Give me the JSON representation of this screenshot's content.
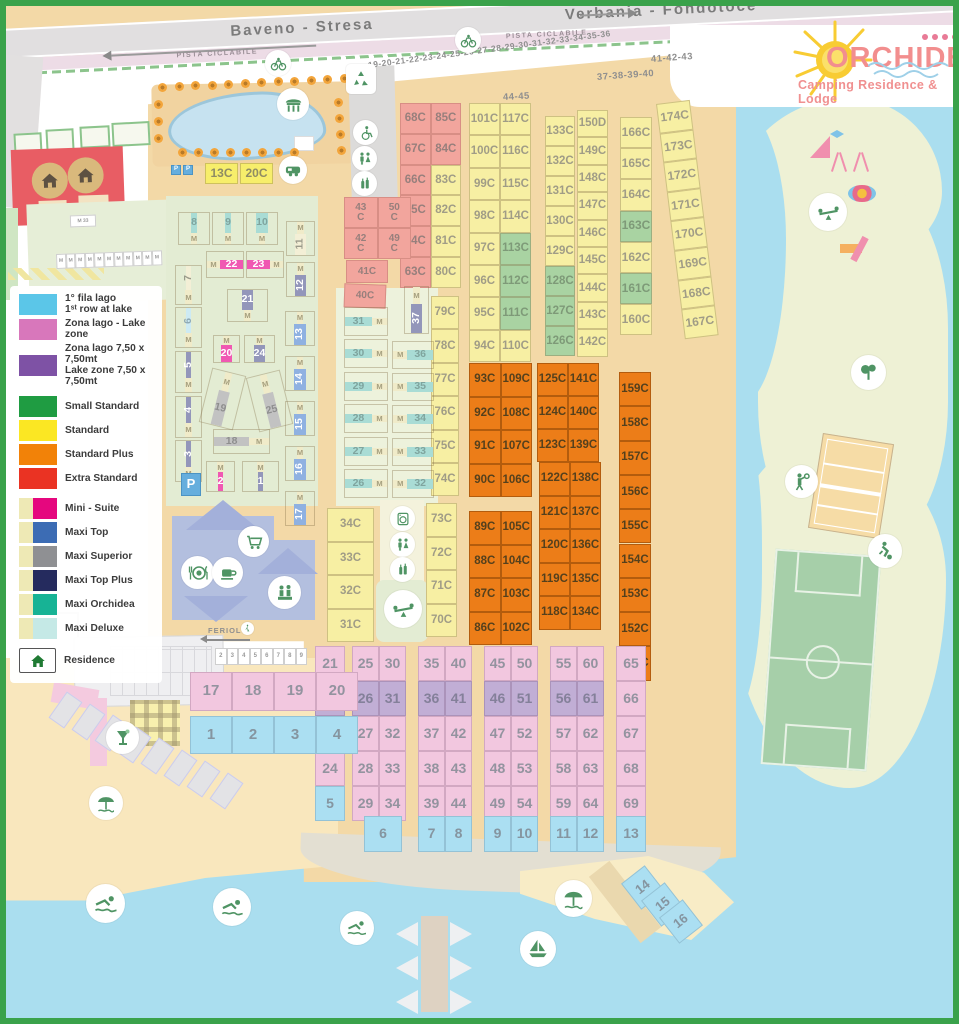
{
  "roads": {
    "left_label": "Baveno - Stresa",
    "right_label": "Verbania - Fondotoce",
    "cycle_path_label": "PISTA CICLABILE",
    "feriolo_label": "FERIOLO"
  },
  "logo": {
    "title": "ORCHIDEA",
    "subtitle": "Camping Residence & Lodge",
    "stars": 4
  },
  "legend": {
    "items": [
      {
        "sw": [
          "#5bc6e8"
        ],
        "t": "1° fila lago",
        "t2": "1ˢᵗ row at lake"
      },
      {
        "sw": [
          "#d877bb"
        ],
        "t": "Zona lago - Lake zone"
      },
      {
        "sw": [
          "#7e52a5"
        ],
        "t": "Zona lago 7,50 x 7,50mt",
        "t2": "Lake zone 7,50 x 7,50mt"
      },
      {
        "sw": [
          "#1f9c42"
        ],
        "t": "Small Standard",
        "gap": true
      },
      {
        "sw": [
          "#fbe723"
        ],
        "t": "Standard"
      },
      {
        "sw": [
          "#f28208"
        ],
        "t": "Standard Plus"
      },
      {
        "sw": [
          "#ea3323"
        ],
        "t": "Extra Standard"
      },
      {
        "sw": [
          "#eee9b5",
          "#e5077e"
        ],
        "t": "Mini - Suite",
        "gap": true
      },
      {
        "sw": [
          "#eee9b5",
          "#3c6cb4"
        ],
        "t": "Maxi Top"
      },
      {
        "sw": [
          "#eee9b5",
          "#8f9093"
        ],
        "t": "Maxi Superior"
      },
      {
        "sw": [
          "#eee9b5",
          "#252b5e"
        ],
        "t": "Maxi Top Plus"
      },
      {
        "sw": [
          "#eee9b5",
          "#17b395"
        ],
        "t": "Maxi Orchidea"
      },
      {
        "sw": [
          "#eee9b5",
          "#c5e9e6"
        ],
        "t": "Maxi Deluxe"
      },
      {
        "house": true,
        "t": "Residence",
        "gap": true
      }
    ]
  },
  "labels": [
    {
      "t": "19-20-21-22-23-24-25-26-27-28-29-30-31-32-33-34-35-36",
      "x": 368,
      "y": 60,
      "fs": 8.5,
      "rot": -7.5
    },
    {
      "t": "37-38-39-40",
      "x": 597,
      "y": 72,
      "fs": 9.5,
      "rot": -4
    },
    {
      "t": "41-42-43",
      "x": 651,
      "y": 54,
      "fs": 9.5,
      "rot": -4
    },
    {
      "t": "44-45",
      "x": 503,
      "y": 92,
      "fs": 9.5,
      "rot": -3
    }
  ],
  "grids": [
    {
      "id": "red-col",
      "x": 400,
      "y": 103,
      "cols": 2,
      "cw": 30.5,
      "ch": 30.8,
      "c": "red",
      "cells": [
        "68C",
        "85C",
        "67C",
        "84C",
        "66C",
        "83C|yellow",
        "65C",
        "82C|yellow",
        "64C",
        "81C|yellow",
        "63C",
        "80C|yellow"
      ]
    },
    {
      "id": "yellow-a",
      "x": 469,
      "y": 103,
      "cols": 2,
      "cw": 31,
      "ch": 32.4,
      "c": "yellow",
      "cells": [
        "101C",
        "117C",
        "100C",
        "116C",
        "99C",
        "115C",
        "98C",
        "114C",
        "97C",
        "113C|green",
        "96C",
        "112C|green",
        "95C",
        "111C|green",
        "94C",
        "110C"
      ]
    },
    {
      "id": "yellow-b",
      "x": 545,
      "y": 116,
      "cols": 1,
      "cw": 30,
      "ch": 30,
      "c": "yellow",
      "cells": [
        "133C",
        "132C",
        "131C",
        "130C",
        "129C",
        "128C|green",
        "127C|green",
        "126C|green"
      ]
    },
    {
      "id": "yellow-c",
      "x": 577,
      "y": 110,
      "cols": 1,
      "cw": 31,
      "ch": 27.4,
      "c": "yellow",
      "cells": [
        "150D",
        "149C",
        "148C",
        "147C",
        "146C",
        "145C",
        "144C",
        "143C",
        "142C"
      ]
    },
    {
      "id": "yellow-d",
      "x": 620,
      "y": 117,
      "cols": 1,
      "cw": 32,
      "ch": 31.2,
      "c": "yellow",
      "fs": 12,
      "cells": [
        "166C",
        "165C",
        "164C",
        "163C|green",
        "162C",
        "161C|green",
        "160C"
      ]
    },
    {
      "id": "yellow-e",
      "x": 656,
      "y": 104,
      "cols": 1,
      "cw": 34,
      "ch": 29.6,
      "c": "yellow",
      "fs": 12,
      "rot": -7,
      "cells": [
        "174C",
        "173C",
        "172C",
        "171C",
        "170C",
        "169C",
        "168C",
        "167C"
      ]
    },
    {
      "id": "yellow-f",
      "x": 431,
      "y": 296,
      "cols": 1,
      "cw": 28,
      "ch": 33.4,
      "c": "yellow",
      "cells": [
        "79C",
        "78C",
        "77C",
        "76C",
        "75C",
        "74C"
      ]
    },
    {
      "id": "yellow-g",
      "x": 426,
      "y": 503,
      "cols": 1,
      "cw": 31,
      "ch": 33.5,
      "c": "yellow",
      "cells": [
        "73C",
        "72C",
        "71C",
        "70C"
      ]
    },
    {
      "id": "yellow-h",
      "x": 327,
      "y": 508,
      "cols": 1,
      "cw": 47,
      "ch": 33.5,
      "c": "yellow",
      "cells": [
        "34C",
        "33C",
        "32C",
        "31C"
      ]
    },
    {
      "id": "orange-a",
      "x": 469,
      "y": 363,
      "cols": 2,
      "cw": 31.5,
      "ch": 33.5,
      "c": "orange",
      "cells": [
        "93C",
        "109C",
        "92C",
        "108C",
        "91C",
        "107C",
        "90C",
        "106C"
      ]
    },
    {
      "id": "orange-b",
      "x": 537,
      "y": 363,
      "cols": 2,
      "cw": 31,
      "ch": 33,
      "c": "orange",
      "cells": [
        "125C",
        "141C",
        "124C",
        "140C",
        "123C",
        "139C"
      ]
    },
    {
      "id": "orange-c",
      "x": 539,
      "y": 462,
      "cols": 2,
      "cw": 31,
      "ch": 33.5,
      "c": "orange",
      "cells": [
        "122C",
        "138C",
        "121C",
        "137C",
        "120C",
        "136C",
        "119C",
        "135C",
        "118C",
        "134C"
      ]
    },
    {
      "id": "orange-d",
      "x": 469,
      "y": 511,
      "cols": 2,
      "cw": 31.5,
      "ch": 33.5,
      "c": "orange",
      "cells": [
        "89C",
        "105C",
        "88C",
        "104C",
        "87C",
        "103C",
        "86C",
        "102C"
      ]
    },
    {
      "id": "orange-e",
      "x": 619,
      "y": 372,
      "cols": 1,
      "cw": 32,
      "ch": 34.3,
      "c": "orange",
      "cells": [
        "159C",
        "158C",
        "157C",
        "156C",
        "155C",
        "154C",
        "153C",
        "152C",
        "151C"
      ]
    },
    {
      "id": "pink-4350",
      "x": 344,
      "y": 197,
      "cols": 2,
      "cw": 33.5,
      "ch": 31,
      "c": "red",
      "fs": 10,
      "cells": [
        "43\nC",
        "50\nC",
        "42\nC",
        "49\nC"
      ]
    },
    {
      "id": "b-21",
      "x": 315,
      "y": 646,
      "cols": 1,
      "cw": 30,
      "ch": 35,
      "c": "pink",
      "fs": 14,
      "cells": [
        "21",
        "22|purple",
        "23",
        "24",
        "5|blue"
      ]
    },
    {
      "id": "b-2530",
      "x": 352,
      "y": 646,
      "cols": 2,
      "cw": 27,
      "ch": 35,
      "c": "pink",
      "fs": 14,
      "cells": [
        "25",
        "30",
        "26|purple",
        "31|purple",
        "27",
        "32",
        "28",
        "33",
        "29",
        "34"
      ]
    },
    {
      "id": "b-3540",
      "x": 418,
      "y": 646,
      "cols": 2,
      "cw": 27,
      "ch": 35,
      "c": "pink",
      "fs": 14,
      "cells": [
        "35",
        "40",
        "36|purple",
        "41|purple",
        "37",
        "42",
        "38",
        "43",
        "39",
        "44"
      ]
    },
    {
      "id": "b-4550",
      "x": 484,
      "y": 646,
      "cols": 2,
      "cw": 27,
      "ch": 35,
      "c": "pink",
      "fs": 14,
      "cells": [
        "45",
        "50",
        "46|purple",
        "51|purple",
        "47",
        "52",
        "48",
        "53",
        "49",
        "54"
      ]
    },
    {
      "id": "b-5560",
      "x": 550,
      "y": 646,
      "cols": 2,
      "cw": 27,
      "ch": 35,
      "c": "pink",
      "fs": 14,
      "cells": [
        "55",
        "60",
        "56|purple",
        "61|purple",
        "57",
        "62",
        "58",
        "63",
        "59",
        "64"
      ]
    },
    {
      "id": "b-65",
      "x": 616,
      "y": 646,
      "cols": 1,
      "cw": 30,
      "ch": 35,
      "c": "pink",
      "fs": 14,
      "cells": [
        "65",
        "66",
        "67",
        "68",
        "69"
      ]
    },
    {
      "id": "b-blue78",
      "x": 418,
      "y": 816,
      "cols": 2,
      "cw": 27,
      "ch": 36,
      "c": "blue",
      "fs": 14,
      "cells": [
        "7",
        "8"
      ]
    },
    {
      "id": "b-blue910",
      "x": 484,
      "y": 816,
      "cols": 2,
      "cw": 27,
      "ch": 36,
      "c": "blue",
      "fs": 14,
      "cells": [
        "9",
        "10"
      ]
    },
    {
      "id": "b-blue1112",
      "x": 550,
      "y": 816,
      "cols": 2,
      "cw": 27,
      "ch": 36,
      "c": "blue",
      "fs": 14,
      "cells": [
        "11",
        "12"
      ]
    },
    {
      "id": "b-1720",
      "x": 190,
      "y": 672,
      "cols": 4,
      "cw": 42,
      "ch": 39,
      "c": "pink",
      "fs": 15,
      "cells": [
        "17",
        "18",
        "19",
        "20"
      ]
    },
    {
      "id": "b-1-4",
      "x": 190,
      "y": 716,
      "cols": 4,
      "cw": 42,
      "ch": 38,
      "c": "blue",
      "fs": 15,
      "cells": [
        "1",
        "2",
        "3",
        "4"
      ]
    },
    {
      "id": "tiny-row",
      "x": 215,
      "y": 648,
      "cols": 8,
      "cw": 11.5,
      "ch": 17,
      "c": "white",
      "fs": 6,
      "cells": [
        "2",
        "3",
        "4",
        "5",
        "6",
        "7",
        "8",
        "9"
      ]
    },
    {
      "id": "m-tiny-row",
      "x": 56,
      "y": 254,
      "cols": 11,
      "cw": 9.6,
      "ch": 15,
      "c": "white",
      "fs": 5,
      "rot": -2,
      "cells": [
        "M",
        "M",
        "M",
        "M",
        "M",
        "M",
        "M",
        "M",
        "M",
        "M",
        "M"
      ]
    }
  ],
  "free_lots": [
    {
      "t": "41C",
      "x": 346,
      "y": 260,
      "w": 42,
      "h": 23,
      "c": "red",
      "fs": 10
    },
    {
      "t": "40C",
      "x": 344,
      "y": 284,
      "w": 42,
      "h": 24,
      "c": "red",
      "fs": 10,
      "rot": 2
    },
    {
      "t": "13C",
      "x": 205,
      "y": 163,
      "w": 33,
      "h": 21,
      "c": "brightyellow",
      "fs": 12
    },
    {
      "t": "20C",
      "x": 240,
      "y": 163,
      "w": 33,
      "h": 21,
      "c": "brightyellow",
      "fs": 12
    },
    {
      "t": "P",
      "x": 171,
      "y": 165,
      "w": 10,
      "h": 10,
      "c": "pblue",
      "fs": 6
    },
    {
      "t": "P",
      "x": 183,
      "y": 165,
      "w": 10,
      "h": 10,
      "c": "pblue",
      "fs": 6
    },
    {
      "t": "31",
      "x": 344,
      "y": 307,
      "w": 44,
      "h": 29,
      "c": "tealM",
      "m": "r"
    },
    {
      "t": "30",
      "x": 344,
      "y": 339,
      "w": 44,
      "h": 29,
      "c": "tealM",
      "m": "r"
    },
    {
      "t": "29",
      "x": 344,
      "y": 372,
      "w": 44,
      "h": 29,
      "c": "tealM",
      "m": "r"
    },
    {
      "t": "28",
      "x": 344,
      "y": 404,
      "w": 44,
      "h": 29,
      "c": "tealM",
      "m": "r"
    },
    {
      "t": "27",
      "x": 344,
      "y": 437,
      "w": 44,
      "h": 29,
      "c": "tealM",
      "m": "r"
    },
    {
      "t": "26",
      "x": 344,
      "y": 469,
      "w": 44,
      "h": 29,
      "c": "tealM",
      "m": "r"
    },
    {
      "t": "36",
      "x": 392,
      "y": 341,
      "w": 42,
      "h": 28,
      "c": "tealM",
      "m": "l"
    },
    {
      "t": "35",
      "x": 392,
      "y": 373,
      "w": 42,
      "h": 28,
      "c": "tealM",
      "m": "l"
    },
    {
      "t": "34",
      "x": 392,
      "y": 405,
      "w": 42,
      "h": 28,
      "c": "tealM",
      "m": "l"
    },
    {
      "t": "33",
      "x": 392,
      "y": 438,
      "w": 42,
      "h": 28,
      "c": "tealM",
      "m": "l"
    },
    {
      "t": "32",
      "x": 392,
      "y": 470,
      "w": 42,
      "h": 28,
      "c": "tealM",
      "m": "l"
    },
    {
      "t": "37",
      "x": 404,
      "y": 286,
      "w": 25,
      "h": 48,
      "c": "navyM",
      "m": "t",
      "vert": true
    },
    {
      "t": "8",
      "x": 178,
      "y": 212,
      "w": 32,
      "h": 33,
      "c": "tealM",
      "m": "b"
    },
    {
      "t": "9",
      "x": 212,
      "y": 212,
      "w": 32,
      "h": 33,
      "c": "tealM",
      "m": "b"
    },
    {
      "t": "10",
      "x": 246,
      "y": 212,
      "w": 32,
      "h": 33,
      "c": "tealM",
      "m": "b"
    },
    {
      "t": "22",
      "x": 206,
      "y": 251,
      "w": 38,
      "h": 27,
      "c": "magenta",
      "m": "l"
    },
    {
      "t": "23",
      "x": 246,
      "y": 251,
      "w": 38,
      "h": 27,
      "c": "magenta",
      "m": "r"
    },
    {
      "t": "21",
      "x": 227,
      "y": 289,
      "w": 41,
      "h": 33,
      "c": "navyM",
      "m": "b"
    },
    {
      "t": "20",
      "x": 213,
      "y": 335,
      "w": 27,
      "h": 28,
      "c": "magenta",
      "m": "t"
    },
    {
      "t": "24",
      "x": 244,
      "y": 335,
      "w": 31,
      "h": 28,
      "c": "navyM",
      "m": "t"
    },
    {
      "t": "19",
      "x": 205,
      "y": 371,
      "w": 35,
      "h": 56,
      "c": "grayM",
      "m": "t",
      "rot": 14
    },
    {
      "t": "25",
      "x": 252,
      "y": 373,
      "w": 35,
      "h": 56,
      "c": "grayM",
      "m": "t",
      "rot": -14
    },
    {
      "t": "18",
      "x": 213,
      "y": 429,
      "w": 57,
      "h": 25,
      "c": "grayM",
      "m": "r"
    },
    {
      "t": "2",
      "x": 206,
      "y": 461,
      "w": 29,
      "h": 31,
      "c": "magenta",
      "m": "t"
    },
    {
      "t": "1",
      "x": 242,
      "y": 461,
      "w": 37,
      "h": 31,
      "c": "navyM",
      "m": "t"
    },
    {
      "t": "7",
      "x": 175,
      "y": 265,
      "w": 27,
      "h": 40,
      "c": "cream2",
      "m": "b",
      "vert": true
    },
    {
      "t": "6",
      "x": 175,
      "y": 307,
      "w": 27,
      "h": 41,
      "c": "ltcyan",
      "m": "b",
      "vert": true
    },
    {
      "t": "5",
      "x": 175,
      "y": 351,
      "w": 27,
      "h": 42,
      "c": "navyM",
      "m": "b",
      "vert": true
    },
    {
      "t": "4",
      "x": 175,
      "y": 396,
      "w": 27,
      "h": 42,
      "c": "navyM",
      "m": "b",
      "vert": true
    },
    {
      "t": "3",
      "x": 175,
      "y": 440,
      "w": 27,
      "h": 42,
      "c": "navyM",
      "m": "b",
      "vert": true
    },
    {
      "t": "11",
      "x": 286,
      "y": 221,
      "w": 29,
      "h": 35,
      "c": "cream2",
      "m": "t",
      "vert": true
    },
    {
      "t": "12",
      "x": 286,
      "y": 262,
      "w": 29,
      "h": 35,
      "c": "navyM",
      "m": "t",
      "vert": true
    },
    {
      "t": "13",
      "x": 285,
      "y": 311,
      "w": 30,
      "h": 35,
      "c": "blueM",
      "m": "t",
      "vert": true
    },
    {
      "t": "14",
      "x": 285,
      "y": 356,
      "w": 30,
      "h": 35,
      "c": "blueM",
      "m": "t",
      "vert": true
    },
    {
      "t": "15",
      "x": 285,
      "y": 401,
      "w": 30,
      "h": 35,
      "c": "blueM",
      "m": "t",
      "vert": true
    },
    {
      "t": "16",
      "x": 285,
      "y": 446,
      "w": 30,
      "h": 35,
      "c": "blueM",
      "m": "t",
      "vert": true
    },
    {
      "t": "17",
      "x": 285,
      "y": 491,
      "w": 30,
      "h": 35,
      "c": "blueM",
      "m": "t",
      "vert": true
    },
    {
      "t": "P",
      "x": 181,
      "y": 473,
      "w": 20,
      "h": 23,
      "c": "pblue",
      "fs": 13
    },
    {
      "t": "6",
      "x": 364,
      "y": 816,
      "w": 38,
      "h": 36,
      "c": "blue",
      "fs": 14
    },
    {
      "t": "13",
      "x": 616,
      "y": 816,
      "w": 30,
      "h": 36,
      "c": "blue",
      "fs": 14
    },
    {
      "t": "14",
      "x": 628,
      "y": 871,
      "w": 30,
      "h": 33,
      "c": "blue",
      "fs": 13,
      "rot": -38
    },
    {
      "t": "15",
      "x": 648,
      "y": 888,
      "w": 30,
      "h": 33,
      "c": "blue",
      "fs": 13,
      "rot": -38
    },
    {
      "t": "16",
      "x": 666,
      "y": 905,
      "w": 30,
      "h": 33,
      "c": "blue",
      "fs": 13,
      "rot": -38
    },
    {
      "t": "M 33",
      "x": 70,
      "y": 215,
      "w": 26,
      "h": 12,
      "c": "white",
      "fs": 5,
      "rot": -2
    }
  ],
  "icons": [
    {
      "n": "bike",
      "x": 265,
      "y": 50,
      "d": 26
    },
    {
      "n": "bike",
      "x": 455,
      "y": 27,
      "d": 26
    },
    {
      "n": "recycle",
      "x": 346,
      "y": 64,
      "d": 30,
      "sq": true
    },
    {
      "n": "gazebo",
      "x": 277,
      "y": 88,
      "d": 32
    },
    {
      "n": "camper",
      "x": 279,
      "y": 156,
      "d": 28
    },
    {
      "n": "wheelchair",
      "x": 353,
      "y": 120,
      "d": 25
    },
    {
      "n": "toilets",
      "x": 352,
      "y": 146,
      "d": 25
    },
    {
      "n": "bottles",
      "x": 352,
      "y": 171,
      "d": 25
    },
    {
      "n": "laundry",
      "x": 390,
      "y": 506,
      "d": 25
    },
    {
      "n": "toilets",
      "x": 390,
      "y": 532,
      "d": 25
    },
    {
      "n": "bottles",
      "x": 390,
      "y": 557,
      "d": 25
    },
    {
      "n": "seesaw",
      "x": 384,
      "y": 590,
      "d": 38
    },
    {
      "n": "cart",
      "x": 238,
      "y": 526,
      "d": 31
    },
    {
      "n": "restaurant",
      "x": 181,
      "y": 556,
      "d": 33
    },
    {
      "n": "cafe",
      "x": 212,
      "y": 557,
      "d": 31
    },
    {
      "n": "reception",
      "x": 268,
      "y": 576,
      "d": 33
    },
    {
      "n": "cocktail",
      "x": 106,
      "y": 721,
      "d": 33
    },
    {
      "n": "umbrella",
      "x": 89,
      "y": 786,
      "d": 34
    },
    {
      "n": "umbrella",
      "x": 555,
      "y": 880,
      "d": 37
    },
    {
      "n": "swimmer",
      "x": 86,
      "y": 884,
      "d": 39
    },
    {
      "n": "swimmer",
      "x": 213,
      "y": 888,
      "d": 38
    },
    {
      "n": "swimmer",
      "x": 340,
      "y": 911,
      "d": 34
    },
    {
      "n": "sailboat",
      "x": 520,
      "y": 931,
      "d": 36
    },
    {
      "n": "seesaw",
      "x": 809,
      "y": 193,
      "d": 38
    },
    {
      "n": "tree",
      "x": 851,
      "y": 355,
      "d": 35
    },
    {
      "n": "volleyball-player",
      "x": 785,
      "y": 465,
      "d": 33
    },
    {
      "n": "soccer-player",
      "x": 868,
      "y": 534,
      "d": 34
    },
    {
      "n": "walking",
      "x": 241,
      "y": 622,
      "d": 13
    }
  ]
}
